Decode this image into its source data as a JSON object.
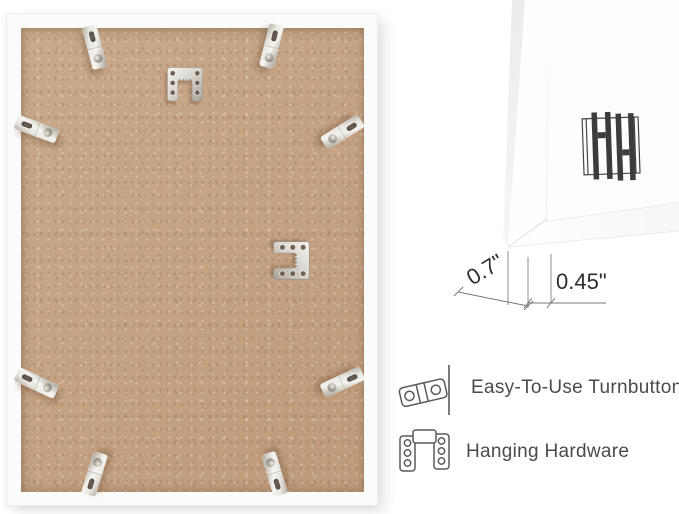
{
  "left_panel": {
    "view": "frame-back-photo",
    "hardware": {
      "turnbutton_count": 8,
      "sawtooth_hanger_count": 2,
      "turnbutton_icon": "turnbutton-icon",
      "sawtooth_icon": "sawtooth-hanger-icon"
    }
  },
  "right_panel": {
    "logo": {
      "name": "hh-logo",
      "letters": "HH"
    },
    "dimensions": {
      "depth": "0.7\"",
      "face_width": "0.45\""
    },
    "features": [
      {
        "icon": "turnbutton-icon",
        "label": "Easy-To-Use Turnbuttons"
      },
      {
        "icon": "hanging-hardware-icon",
        "label": "Hanging Hardware"
      }
    ]
  },
  "colors": {
    "background": "#ffffff",
    "frame_white": "#fbfbfb",
    "board_tan": "#c6a383",
    "metal_silver": "#d9d7d1",
    "label_text": "#4b4b4b",
    "dimension_text": "#2d2d2d",
    "logo_dark": "#3c3c3c",
    "icon_outline": "#5a5a5a"
  }
}
